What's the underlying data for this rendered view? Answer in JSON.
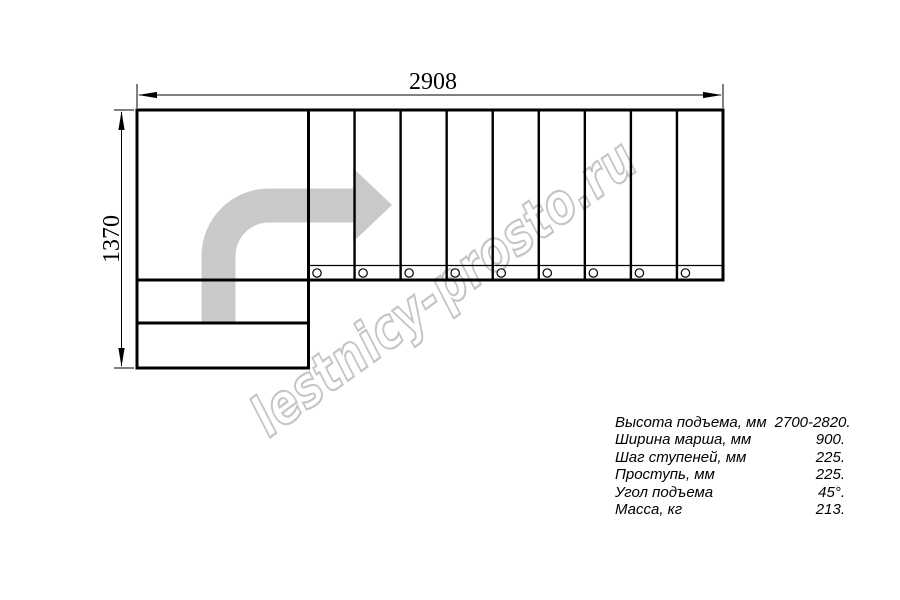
{
  "drawing": {
    "dim_width_label": "2908",
    "dim_height_label": "1370",
    "step_count": 9
  },
  "watermark": {
    "text": "lestnicy-prosto.ru"
  },
  "specs": [
    {
      "label": "Высота подъема, мм",
      "value": "2700-2820."
    },
    {
      "label": "Ширина марша, мм",
      "value": "900."
    },
    {
      "label": "Шаг ступеней, мм",
      "value": "225."
    },
    {
      "label": "Проступь, мм",
      "value": "225."
    },
    {
      "label": "Угол подъема",
      "value": "45°."
    },
    {
      "label": "Масса, кг",
      "value": "213."
    }
  ],
  "colors": {
    "line": "#000000",
    "arrow_fill": "#c9c9c9",
    "watermark_stroke": "#c5c5c5"
  }
}
